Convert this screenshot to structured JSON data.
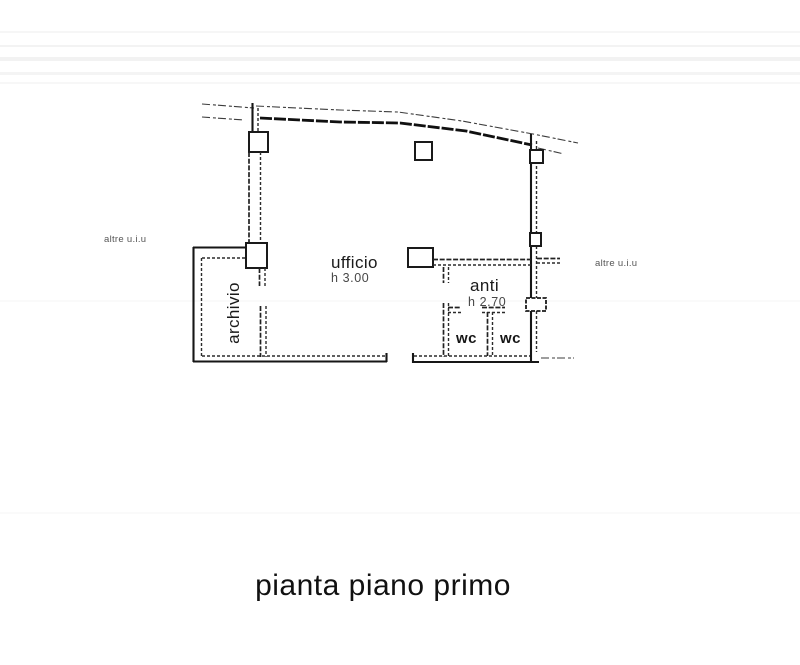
{
  "page": {
    "title": "pianta piano primo",
    "background": "#ffffff",
    "line_color": "#1c1c1c"
  },
  "plan": {
    "rooms": {
      "ufficio": {
        "label": "ufficio",
        "height": "h 3.00"
      },
      "archivio": {
        "label": "archivio"
      },
      "anti": {
        "label": "anti",
        "height": "h 2.70"
      },
      "wc_left": {
        "label": "wc"
      },
      "wc_right": {
        "label": "wc"
      }
    },
    "adjacent_labels": {
      "left": "altre u.i.u",
      "right": "altre u.i.u"
    }
  }
}
